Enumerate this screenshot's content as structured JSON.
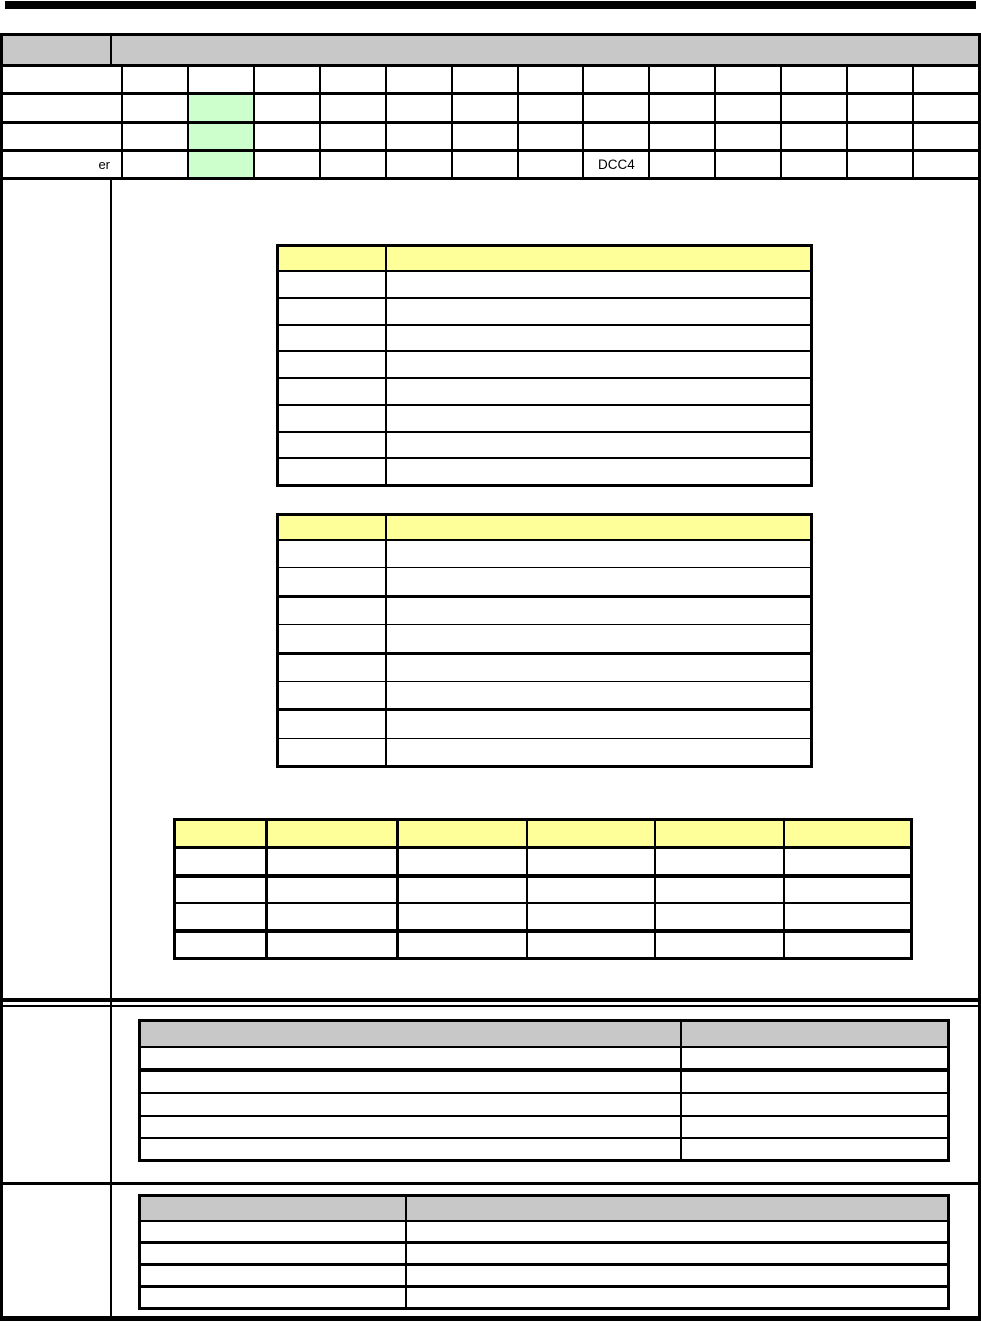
{
  "colors": {
    "top_rule": "#000000",
    "header_gray": "#c8c8c8",
    "panel_yellow": "#ffff99",
    "highlight_green": "#ccffcc",
    "grid_border": "#000000"
  },
  "top_register_table": {
    "header": {
      "label_cell": "",
      "span_cell": ""
    },
    "column_count": 13,
    "green_highlight": {
      "column": 2,
      "rows": [
        2,
        3,
        4
      ]
    },
    "rows": [
      {
        "label": "",
        "cells": [
          "",
          "",
          "",
          "",
          "",
          "",
          "",
          "",
          "",
          "",
          "",
          "",
          ""
        ]
      },
      {
        "label": "",
        "cells": [
          "",
          "",
          "",
          "",
          "",
          "",
          "",
          "",
          "",
          "",
          "",
          "",
          ""
        ]
      },
      {
        "label": "",
        "cells": [
          "",
          "",
          "",
          "",
          "",
          "",
          "",
          "",
          "",
          "",
          "",
          "",
          ""
        ]
      },
      {
        "label": "er",
        "cells": [
          "",
          "",
          "",
          "",
          "",
          "",
          "",
          "DCC4",
          "",
          "",
          "",
          "",
          ""
        ]
      }
    ]
  },
  "field_table_1": {
    "header": [
      "",
      ""
    ],
    "column_count": 2,
    "row_count": 8,
    "rows": [
      [
        "",
        ""
      ],
      [
        "",
        ""
      ],
      [
        "",
        ""
      ],
      [
        "",
        ""
      ],
      [
        "",
        ""
      ],
      [
        "",
        ""
      ],
      [
        "",
        ""
      ],
      [
        "",
        ""
      ]
    ]
  },
  "field_table_2": {
    "header": [
      "",
      ""
    ],
    "column_count": 2,
    "row_count": 8,
    "rows": [
      [
        "",
        ""
      ],
      [
        "",
        ""
      ],
      [
        "",
        ""
      ],
      [
        "",
        ""
      ],
      [
        "",
        ""
      ],
      [
        "",
        ""
      ],
      [
        "",
        ""
      ],
      [
        "",
        ""
      ]
    ]
  },
  "summary_table": {
    "header": [
      "",
      "",
      "",
      "",
      "",
      ""
    ],
    "column_count": 6,
    "row_count": 4,
    "rows": [
      [
        "",
        "",
        "",
        "",
        "",
        ""
      ],
      [
        "",
        "",
        "",
        "",
        "",
        ""
      ],
      [
        "",
        "",
        "",
        "",
        "",
        ""
      ],
      [
        "",
        "",
        "",
        "",
        "",
        ""
      ]
    ]
  },
  "note_table_1": {
    "header": [
      "",
      ""
    ],
    "column_count": 2,
    "row_count": 5,
    "rows": [
      [
        "",
        ""
      ],
      [
        "",
        ""
      ],
      [
        "",
        ""
      ],
      [
        "",
        ""
      ],
      [
        "",
        ""
      ]
    ]
  },
  "note_table_2": {
    "header": [
      "",
      ""
    ],
    "column_count": 2,
    "row_count": 4,
    "rows": [
      [
        "",
        ""
      ],
      [
        "",
        ""
      ],
      [
        "",
        ""
      ],
      [
        "",
        ""
      ]
    ]
  }
}
